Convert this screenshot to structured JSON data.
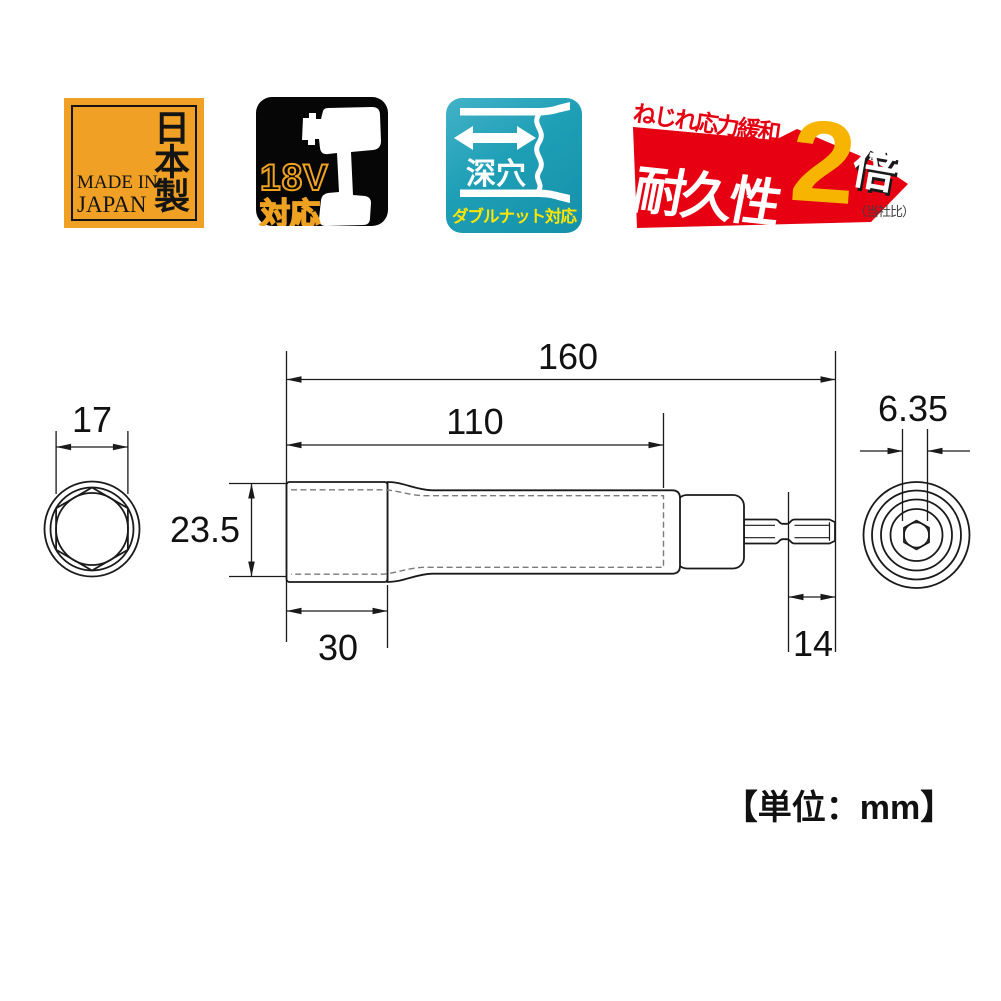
{
  "page": {
    "unit_label": "【単位：mm】",
    "bg_color": "#ffffff",
    "line_color": "#1a1a1a"
  },
  "badges": {
    "made_in_japan": {
      "vertical_text": "日本製",
      "line1": "MADE IN",
      "line2": "JAPAN",
      "bg_color": "#F0A125"
    },
    "volt_18v": {
      "volts": "18V",
      "suffix": "対応",
      "accent_color": "#EFA221",
      "bg_color": "#000000"
    },
    "deep_socket": {
      "label": "深穴",
      "banner": "ダブルナット対応",
      "bg_color": "#1E9FB6",
      "banner_text_color": "#FFE600"
    },
    "durability": {
      "tagline": "ねじれ応力緩和",
      "headline": "耐久性",
      "multiplier": "2",
      "times": "倍",
      "note": "（当社比）",
      "red_color": "#E60012",
      "amber_color": "#F7B400"
    }
  },
  "drawing": {
    "dimensions": {
      "overall_length_mm": "160",
      "hole_depth_mm": "110",
      "body_diameter_mm": "23.5",
      "head_length_mm": "30",
      "hex_opening_mm": "17",
      "shank_hex_mm": "6.35",
      "shank_tip_length_mm": "14"
    }
  }
}
